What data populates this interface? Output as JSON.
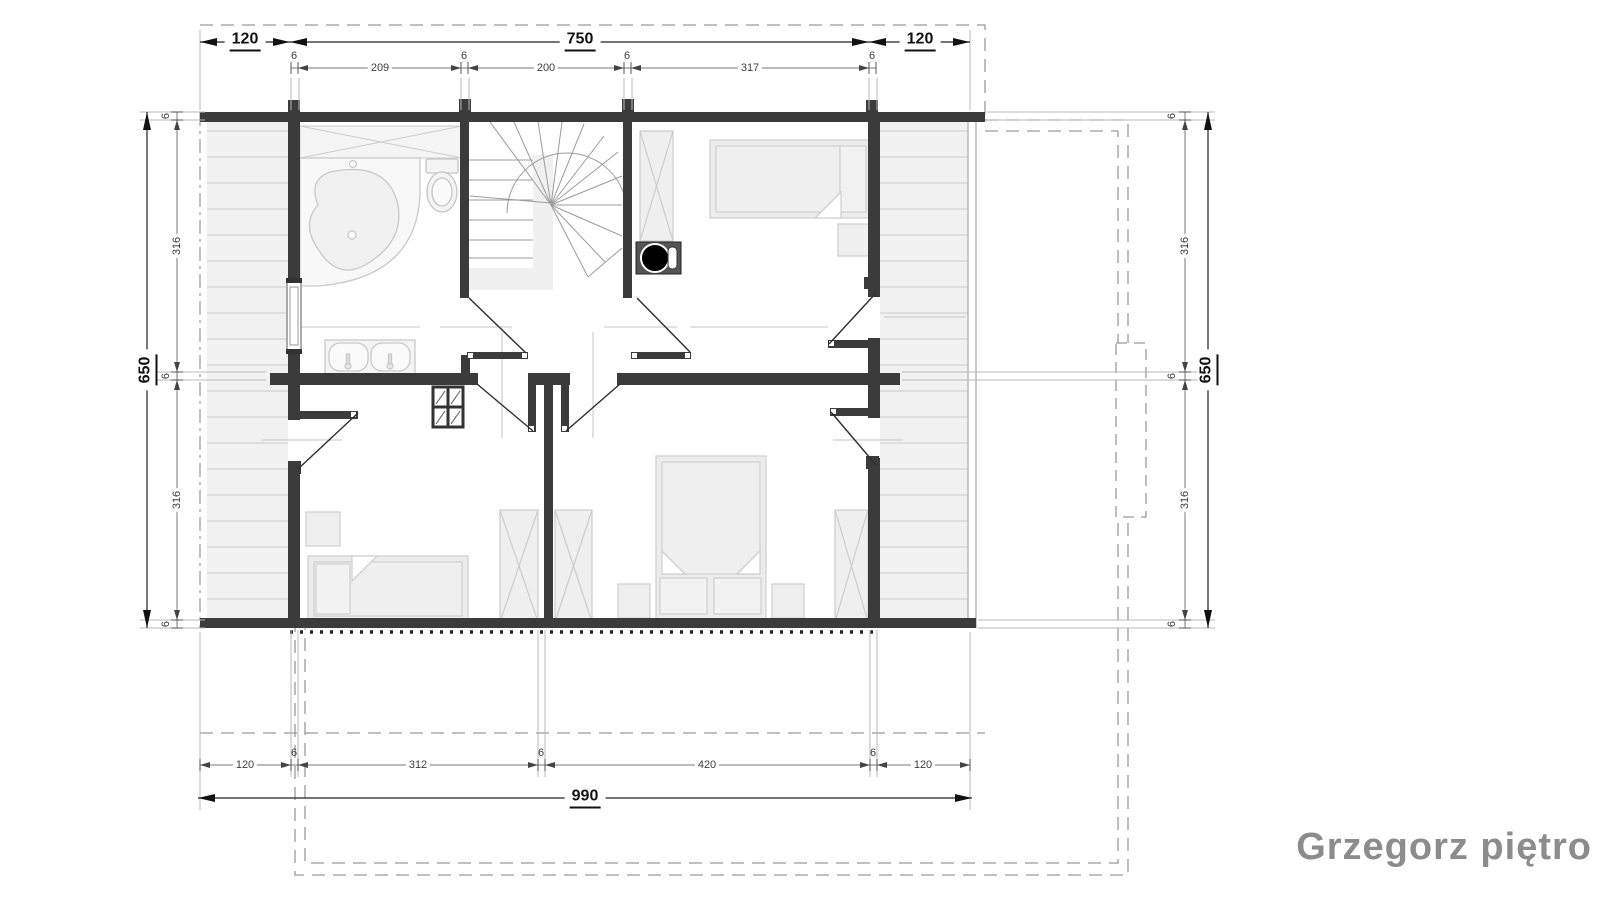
{
  "title": {
    "text": "Grzegorz piętro"
  },
  "dimensions": {
    "top_main": [
      "120",
      "750",
      "120"
    ],
    "top_sub": [
      "6",
      "209",
      "6",
      "200",
      "6",
      "317",
      "6"
    ],
    "left_main": "650",
    "left_sub": [
      "6",
      "316",
      "6",
      "316",
      "6"
    ],
    "right_main": "650",
    "right_sub": [
      "6",
      "316",
      "6",
      "316",
      "6"
    ],
    "bottom_sub": [
      "120",
      "6",
      "312",
      "6",
      "420",
      "6",
      "120"
    ],
    "bottom_main": "990"
  },
  "colors": {
    "wall": "#3b3b3b",
    "dimension_main": "#111111",
    "dimension_sub": "#3d3d3d",
    "furniture_line": "#c9c9c9",
    "furniture_fill": "#ededed",
    "deck_fill": "#f1f1f1",
    "deck_hatch": "#d7d7d7",
    "roof_dashed": "#9a9a9a",
    "title_text": "#8c8c8c"
  },
  "plan_symbols": [
    "corner-bathtub",
    "toilet",
    "double-sink",
    "stair-winder",
    "wood-stove",
    "single-bed",
    "double-bed",
    "wardrobe",
    "nightstand",
    "deck-hatching",
    "roof-overhang-dashed",
    "chimney-outline",
    "door-swing",
    "window"
  ]
}
